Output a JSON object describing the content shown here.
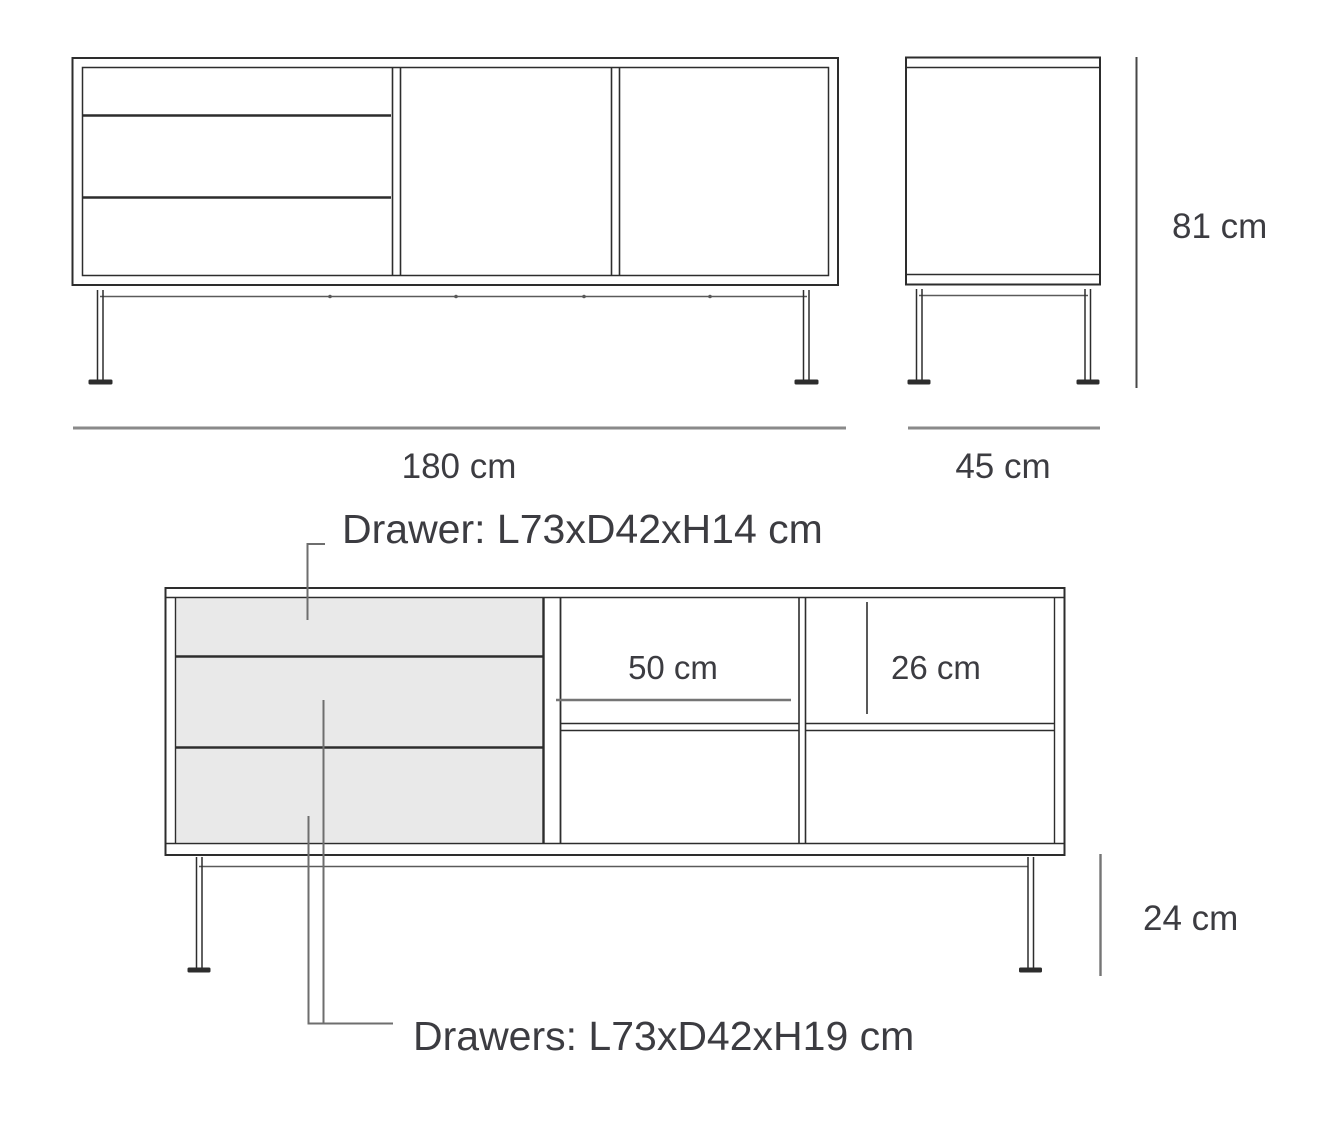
{
  "title": "Sideboard dimension diagram",
  "views": {
    "front": {
      "width_label": "180 cm"
    },
    "side": {
      "depth_label": "45 cm",
      "height_label": "81 cm"
    },
    "detail": {
      "top_drawer_label": "Drawer: L73xD42xH14 cm",
      "bottom_drawers_label": "Drawers: L73xD42xH19 cm",
      "compartment_width_label": "50 cm",
      "compartment_height_label": "26 cm",
      "leg_height_label": "24 cm"
    }
  },
  "colors": {
    "background": "#ffffff",
    "outline": "#2d2d2d",
    "rail": "#5a5a5a",
    "dimension_line": "#8a8a8a",
    "dimension_mid": "#757575",
    "dimension_dark": "#474747",
    "leader_line": "#6e6e6e",
    "text": "#3c3c41",
    "drawer_fill": "#e9e9e9"
  }
}
